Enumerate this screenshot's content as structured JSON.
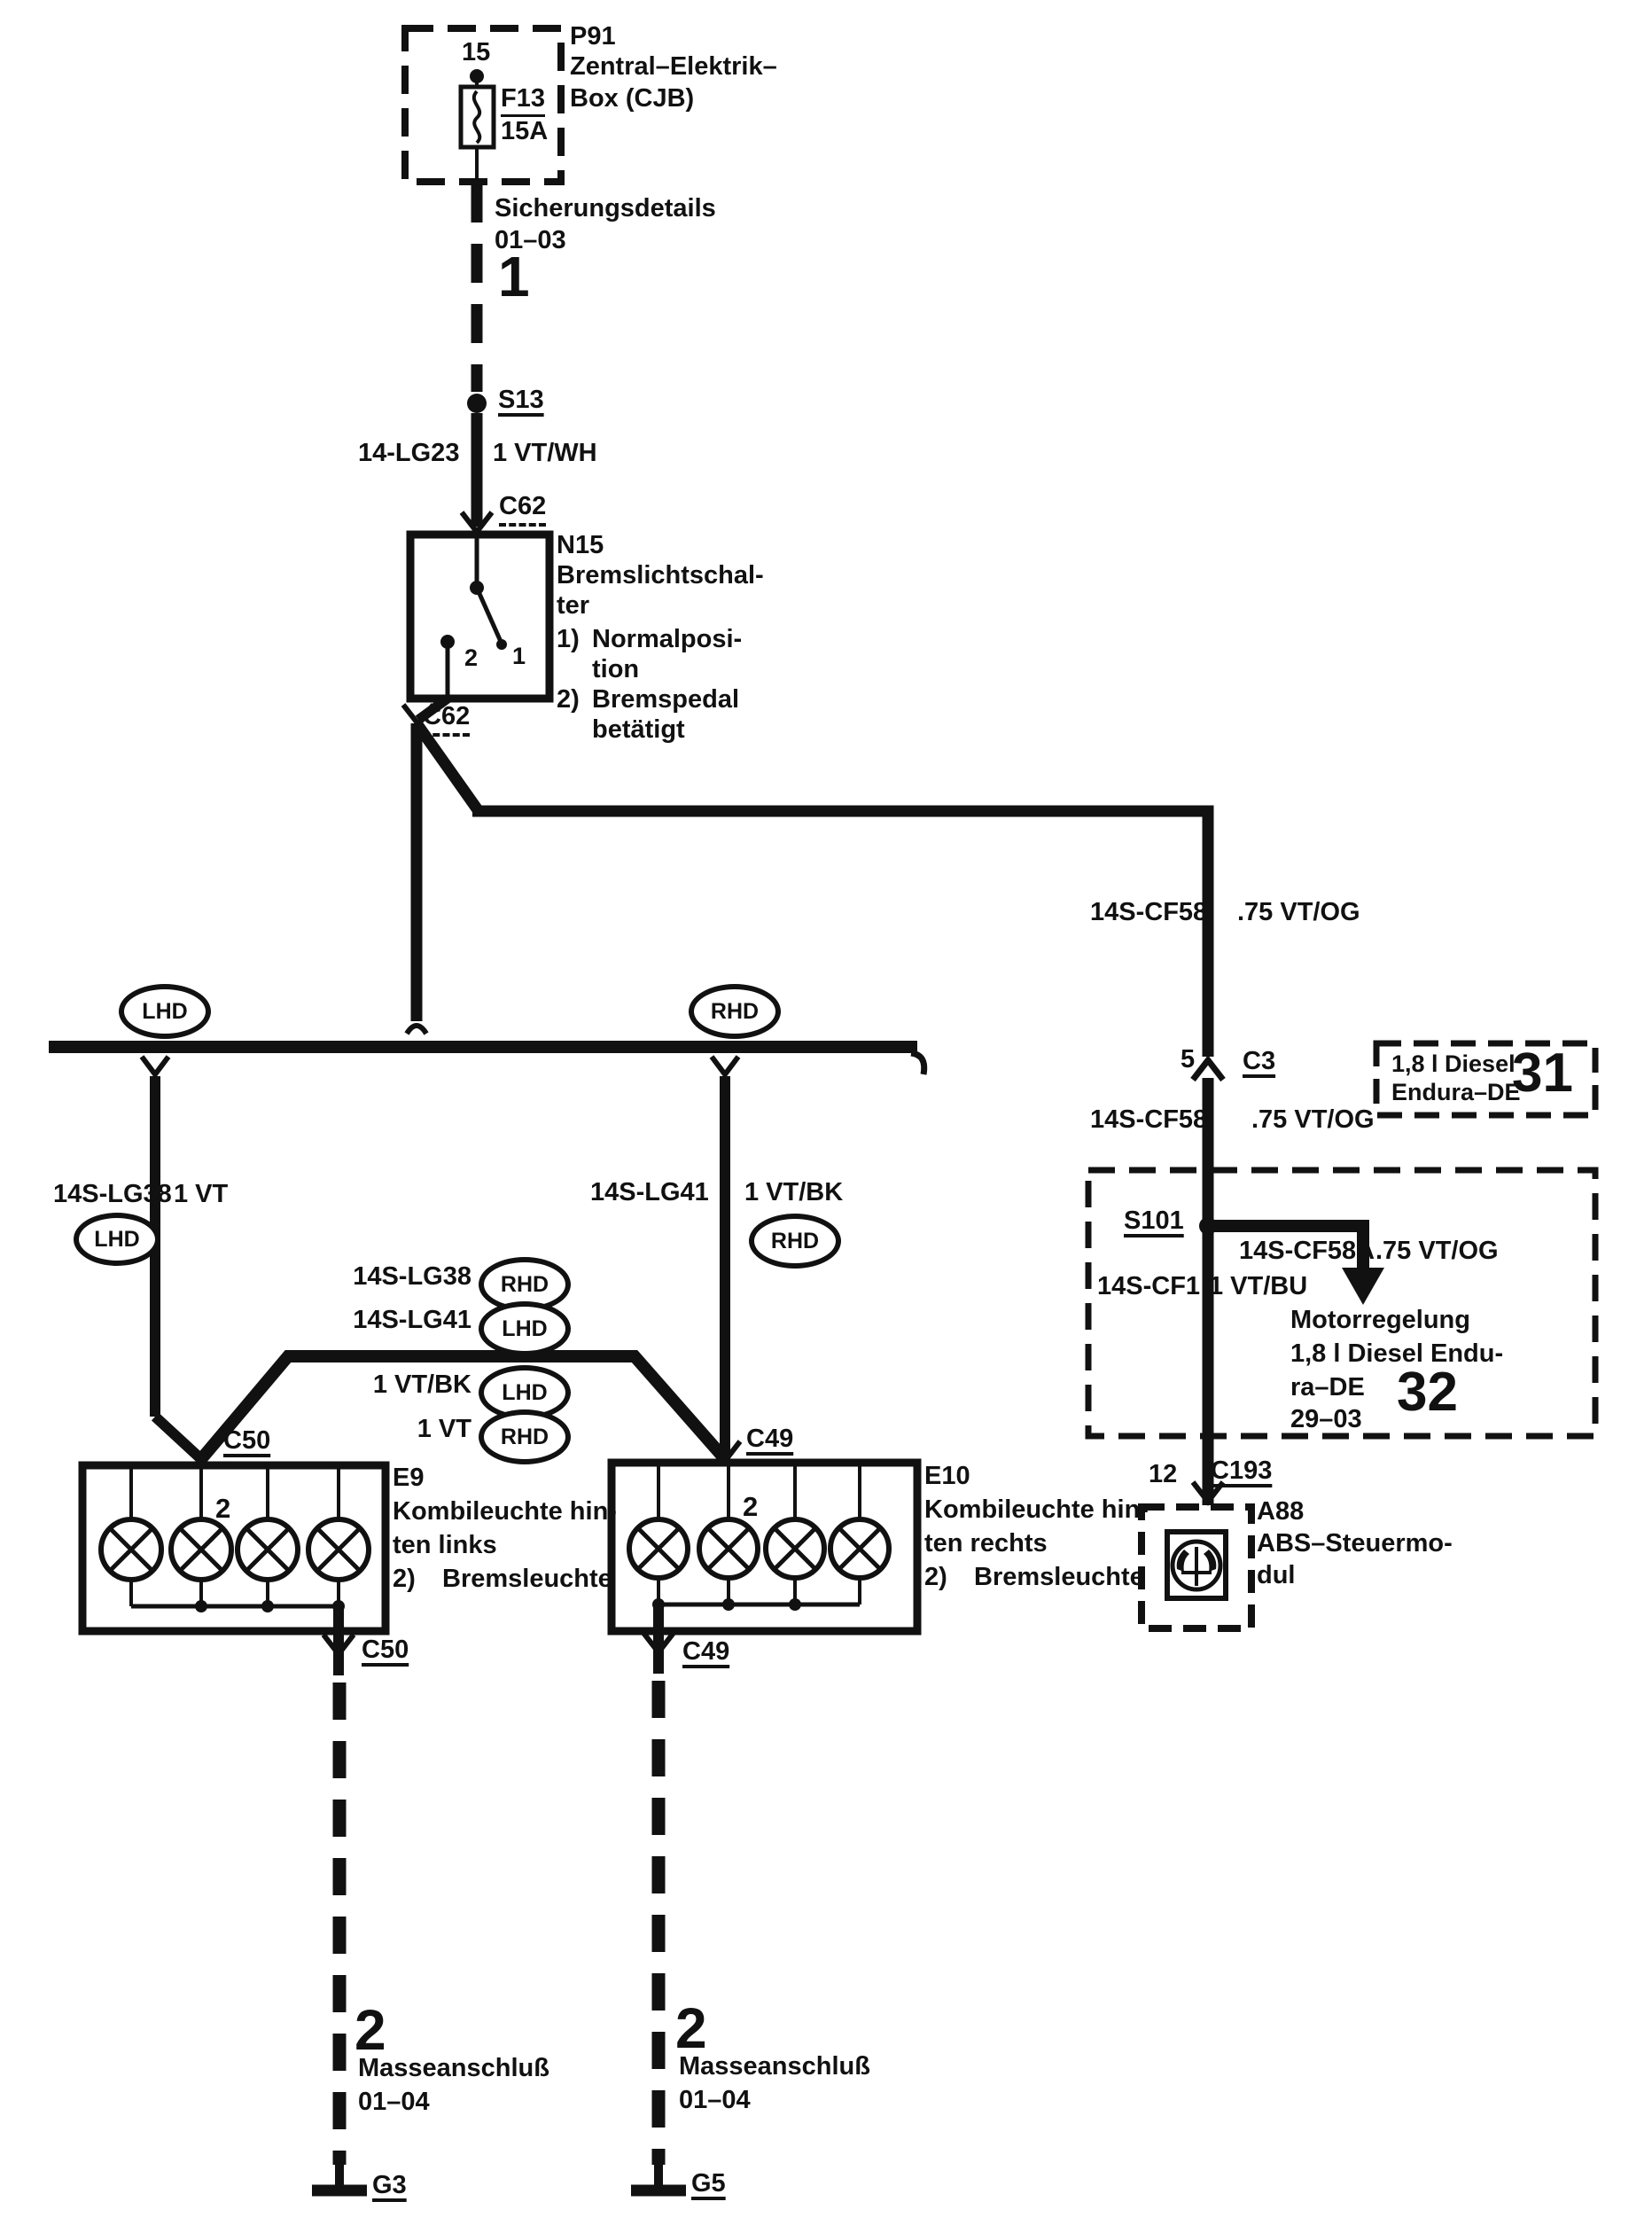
{
  "colors": {
    "ink": "#111111",
    "paper": "#ffffff"
  },
  "cjb": {
    "id": "P91",
    "name_line1": "Zentral–Elektrik–",
    "name_line2": "Box (CJB)",
    "pin": "15",
    "fuse_id": "F13",
    "fuse_rating": "15A",
    "details": "Sicherungsdetails",
    "details_ref": "01–03",
    "page_num": "1"
  },
  "s13": {
    "label": "S13"
  },
  "wire_feed": {
    "circuit": "14-LG23",
    "spec": "1 VT/WH"
  },
  "c62": {
    "top": "C62",
    "bottom": "C62"
  },
  "n15": {
    "id": "N15",
    "name1": "Bremslichtschal-",
    "name2": "ter",
    "pos1_num": "1)",
    "pos1a": "Normalposi-",
    "pos1b": "tion",
    "pos2_num": "2)",
    "pos2a": "Bremspedal",
    "pos2b": "betätigt",
    "contact_left": "2",
    "contact_right": "1"
  },
  "right_feed": {
    "circuit1": "14S-CF58",
    "spec1": ".75 VT/OG",
    "pin": "5",
    "connector": "C3",
    "circuit2": "14S-CF58",
    "spec2": ".75 VT/OG"
  },
  "box31": {
    "line1": "1,8 l Diesel",
    "line2": "Endura–DE",
    "num": "31"
  },
  "box32": {
    "splice": "S101",
    "branch_circuit": "14S-CF58A",
    "branch_spec": ".75 VT/OG",
    "circuit": "14S-CF1",
    "spec": "1 VT/BU",
    "t1": "Motorregelung",
    "t2": "1,8 l Diesel Endu-",
    "t3": "ra–DE",
    "t4": "29–03",
    "num": "32"
  },
  "c193": {
    "pin": "12",
    "label": "C193"
  },
  "abs": {
    "id": "A88",
    "name1": "ABS–Steuermo-",
    "name2": "dul"
  },
  "bus": {
    "lhd": "LHD",
    "rhd": "RHD"
  },
  "left_branch": {
    "circuit": "14S-LG38",
    "spec": "1 VT",
    "badge": "LHD"
  },
  "right_branch": {
    "circuit": "14S-LG41",
    "spec": "1 VT/BK",
    "badge": "RHD"
  },
  "crossover": {
    "rows": [
      {
        "label": "14S-LG38",
        "badge": "RHD"
      },
      {
        "label": "14S-LG41",
        "badge": "LHD"
      },
      {
        "label": "1 VT/BK",
        "badge": "LHD"
      },
      {
        "label": "1 VT",
        "badge": "RHD"
      }
    ]
  },
  "e9": {
    "conn_top": "C50",
    "conn_bottom": "C50",
    "id": "E9",
    "name1": "Kombileuchte hin-",
    "name2": "ten links",
    "fn_num": "2)",
    "fn": "Bremsleuchte",
    "lamp_pin": "2"
  },
  "e10": {
    "conn_top": "C49",
    "conn_bottom": "C49",
    "id": "E10",
    "name1": "Kombileuchte hin-",
    "name2": "ten rechts",
    "fn_num": "2)",
    "fn": "Bremsleuchte",
    "lamp_pin": "2"
  },
  "ground_left": {
    "num": "2",
    "name": "Masseanschluß",
    "ref": "01–04",
    "id": "G3"
  },
  "ground_right": {
    "num": "2",
    "name": "Masseanschluß",
    "ref": "01–04",
    "id": "G5"
  }
}
